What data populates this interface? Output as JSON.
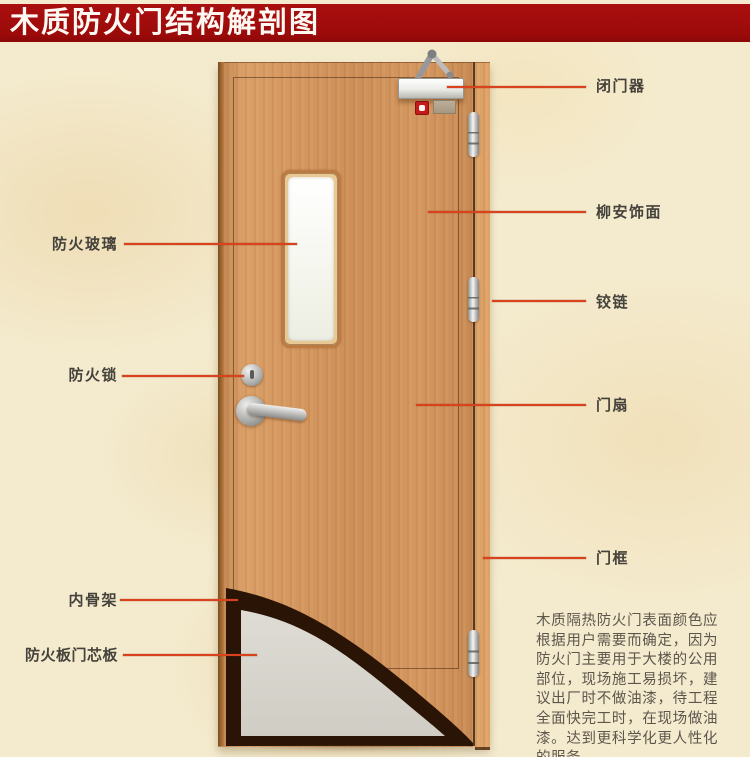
{
  "title": "木质防火门结构解剖图",
  "annotations": {
    "left": [
      {
        "text": "防火玻璃"
      },
      {
        "text": "防火锁"
      },
      {
        "text": "内骨架"
      },
      {
        "text": "防火板门芯板"
      }
    ],
    "right": [
      {
        "text": "闭门器"
      },
      {
        "text": "柳安饰面"
      },
      {
        "text": "铰链"
      },
      {
        "text": "门扇"
      },
      {
        "text": "门框"
      }
    ]
  },
  "description": "木质隔热防火门表面颜色应根据用户需要而确定，因为防火门主要用于大楼的公用部位，现场施工易损坏，建议出厂时不做油漆，待工程全面快完工时，在现场做油漆。达到更科学化更人性化的服务。",
  "colors": {
    "banner_red": "#9c0a0a",
    "leader_line": "#d8421c",
    "door_wood": "#d49760",
    "inner_frame_dark": "#2a1406",
    "core_board_grey": "#d8d7ce",
    "background_parchment": "#f4ebcf",
    "label_text": "#45423b"
  }
}
